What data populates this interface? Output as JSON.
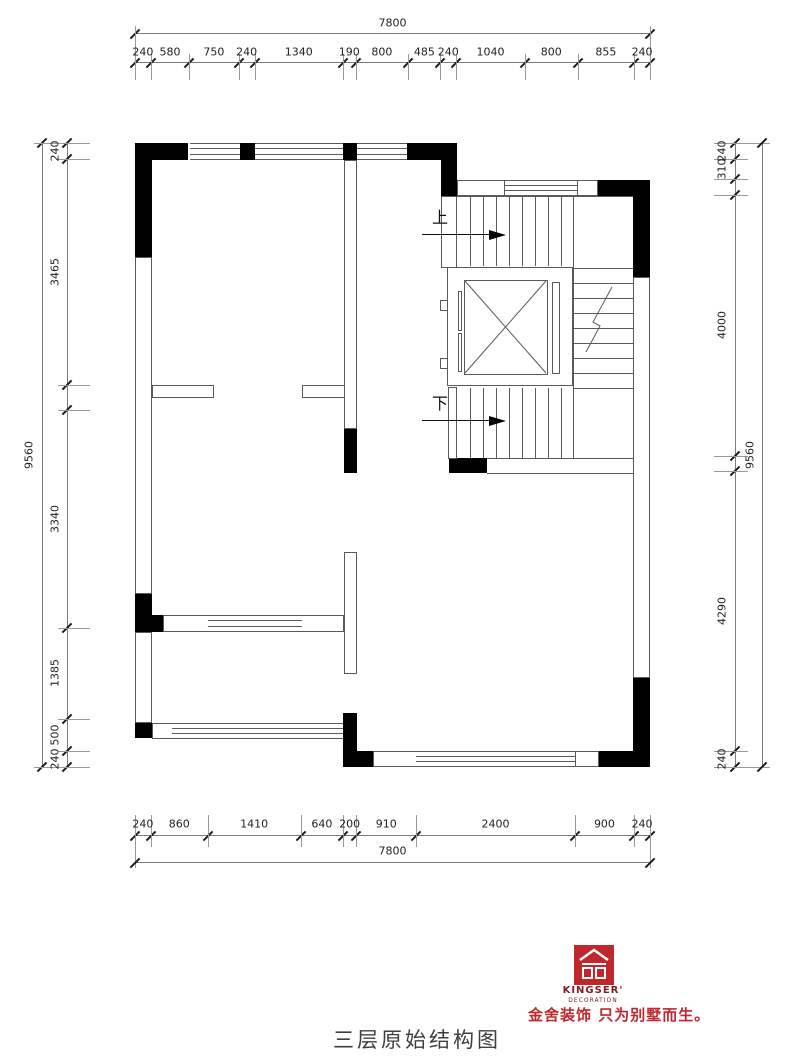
{
  "plan": {
    "caption": "三层原始结构图",
    "stairs": {
      "up_label": "上",
      "down_label": "下"
    }
  },
  "dimensions": {
    "top": {
      "total": "7800",
      "segments": [
        {
          "mm": 240,
          "label": "240"
        },
        {
          "mm": 580,
          "label": "580"
        },
        {
          "mm": 750,
          "label": "750"
        },
        {
          "mm": 240,
          "label": "240"
        },
        {
          "mm": 1340,
          "label": "1340"
        },
        {
          "mm": 190,
          "label": "190"
        },
        {
          "mm": 800,
          "label": "800"
        },
        {
          "mm": 485,
          "label": "485"
        },
        {
          "mm": 240,
          "label": "240"
        },
        {
          "mm": 1040,
          "label": "1040"
        },
        {
          "mm": 800,
          "label": "800"
        },
        {
          "mm": 855,
          "label": "855"
        },
        {
          "mm": 240,
          "label": "240"
        }
      ]
    },
    "bottom": {
      "total": "7800",
      "segments": [
        {
          "mm": 240,
          "label": "240"
        },
        {
          "mm": 860,
          "label": "860"
        },
        {
          "mm": 1410,
          "label": "1410"
        },
        {
          "mm": 640,
          "label": "640"
        },
        {
          "mm": 200,
          "label": "200"
        },
        {
          "mm": 910,
          "label": "910"
        },
        {
          "mm": 2400,
          "label": "2400"
        },
        {
          "mm": 900,
          "label": "900"
        },
        {
          "mm": 240,
          "label": "240"
        }
      ]
    },
    "left": {
      "total": "9560",
      "segments": [
        {
          "mm": 240,
          "label": "240"
        },
        {
          "mm": 3465,
          "label": "3465"
        },
        {
          "mm": 390,
          "label": ""
        },
        {
          "mm": 3340,
          "label": "3340"
        },
        {
          "mm": 1385,
          "label": "1385"
        },
        {
          "mm": 500,
          "label": "500"
        },
        {
          "mm": 240,
          "label": "240"
        }
      ]
    },
    "right": {
      "total": "9560",
      "segments": [
        {
          "mm": 240,
          "label": "240"
        },
        {
          "mm": 310,
          "label": "310"
        },
        {
          "mm": 240,
          "label": ""
        },
        {
          "mm": 4000,
          "label": "4000"
        },
        {
          "mm": 240,
          "label": ""
        },
        {
          "mm": 4290,
          "label": "4290"
        },
        {
          "mm": 240,
          "label": "240"
        }
      ]
    }
  },
  "branding": {
    "name": "KINGSER'",
    "subtitle": "DECORATION",
    "tagline": "金舍装饰 只为别墅而生。",
    "brand_red": "#c0272d",
    "brand_dark_red": "#7d2026"
  },
  "colors": {
    "wall": "#000000",
    "line": "#5a5a5a",
    "dim_text": "#222222"
  }
}
